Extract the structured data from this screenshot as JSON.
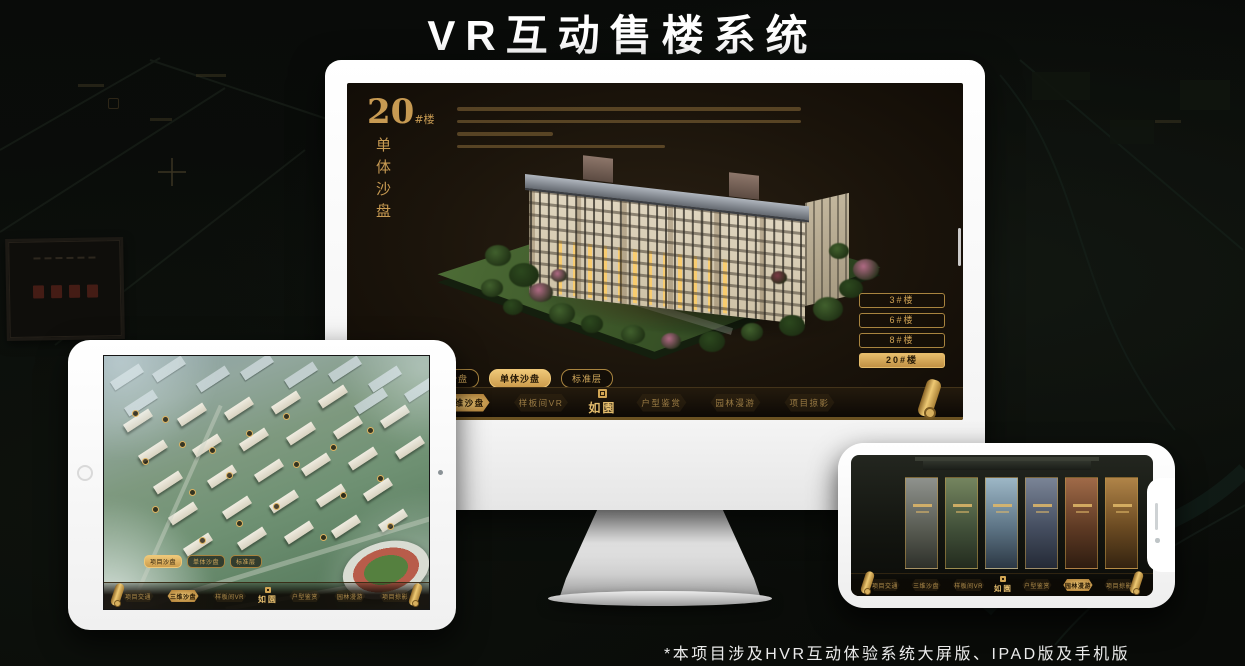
{
  "page": {
    "title": "VR互动售楼系统",
    "footnote": "*本项目涉及HVR互动体验系统大屏版、IPAD版及手机版"
  },
  "colors": {
    "gold": "#c79a52",
    "gold_bright": "#e3bc6d",
    "screen_background": "#1b140b",
    "page_background": "#0a0c0a"
  },
  "nav": {
    "left": [
      "项目交通",
      "三维沙盘",
      "样板间VR"
    ],
    "logo": "如園",
    "right": [
      "户型鉴赏",
      "园林漫游",
      "项目掠影"
    ]
  },
  "sub_tabs": [
    "项目沙盘",
    "单体沙盘",
    "标准层"
  ],
  "monitor": {
    "block_number": "20",
    "block_unit": "#楼",
    "block_name": "单体沙盘",
    "building_buttons": [
      "3#楼",
      "6#楼",
      "8#楼",
      "20#楼"
    ],
    "active_building": "20#楼",
    "active_sub_tab": "单体沙盘",
    "active_nav": "三维沙盘"
  },
  "tablet": {
    "active_sub_tab": "项目沙盘",
    "active_nav": "三维沙盘"
  },
  "phone": {
    "active_nav": "园林漫游"
  }
}
